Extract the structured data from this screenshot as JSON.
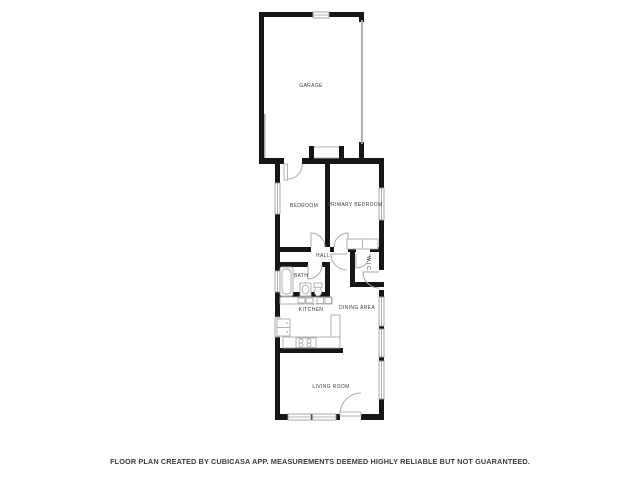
{
  "floor_plan": {
    "rooms": [
      {
        "id": "garage",
        "label": "GARAGE"
      },
      {
        "id": "bedroom",
        "label": "BEDROOM"
      },
      {
        "id": "primary-bedroom",
        "label": "PRIMARY BEDROOM"
      },
      {
        "id": "hall",
        "label": "HALL"
      },
      {
        "id": "wic",
        "label": "W.I.C."
      },
      {
        "id": "bath",
        "label": "BATH"
      },
      {
        "id": "kitchen",
        "label": "KITCHEN"
      },
      {
        "id": "dining-area",
        "label": "DINING AREA"
      },
      {
        "id": "living-room",
        "label": "LIVING ROOM"
      }
    ],
    "footer": "FLOOR PLAN CREATED BY CUBICASA APP. MEASUREMENTS DEEMED HIGHLY RELIABLE BUT NOT GUARANTEED.",
    "colors": {
      "wall": "#161616",
      "window": "#9c9c9c",
      "fixture": "#aaaaaa",
      "text": "#3c3c3c",
      "background": "#ffffff"
    }
  }
}
